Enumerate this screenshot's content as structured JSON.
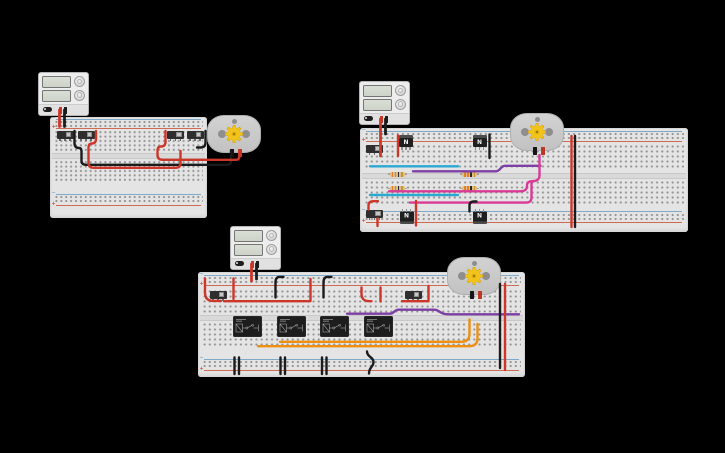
{
  "app": {
    "name": "circuit-canvas",
    "background": "#000000"
  },
  "labels": {
    "mosfet": "N",
    "rail_plus": "+",
    "rail_minus": "−"
  },
  "colors": {
    "board": "#e4e4e4",
    "wire_red": "#cc372a",
    "wire_black": "#1b1b1b",
    "wire_cyan": "#2aa9d2",
    "wire_purple": "#7d3fa5",
    "wire_pink": "#d93a96",
    "wire_orange": "#ed8f13",
    "gear": "#f2c318"
  },
  "board_layouts": {
    "b1": [
      {
        "t": "line",
        "y": 1.5,
        "color": "blue"
      },
      {
        "t": "holes",
        "y": 2.5,
        "h": 8,
        "rows": 2
      },
      {
        "t": "line",
        "y": 11,
        "color": "red"
      },
      {
        "t": "holes",
        "y": 13,
        "h": 22,
        "rows": 5
      },
      {
        "t": "channel",
        "y": 35.5,
        "h": 6.5
      },
      {
        "t": "holes",
        "y": 42.5,
        "h": 22,
        "rows": 5
      },
      {
        "t": "line",
        "y": 76.5,
        "color": "blue"
      },
      {
        "t": "holes",
        "y": 78,
        "h": 8,
        "rows": 2
      },
      {
        "t": "line",
        "y": 87.5,
        "color": "red"
      }
    ],
    "b2": [
      {
        "t": "line",
        "y": 2.5,
        "color": "blue"
      },
      {
        "t": "holes",
        "y": 3.5,
        "h": 8,
        "rows": 2
      },
      {
        "t": "line",
        "y": 12.5,
        "color": "red"
      },
      {
        "t": "holes",
        "y": 16,
        "h": 25,
        "rows": 5
      },
      {
        "t": "channel",
        "y": 44.5,
        "h": 6
      },
      {
        "t": "holes",
        "y": 51.5,
        "h": 25,
        "rows": 5
      },
      {
        "t": "line",
        "y": 83,
        "color": "blue"
      },
      {
        "t": "holes",
        "y": 84.5,
        "h": 8,
        "rows": 2
      },
      {
        "t": "line",
        "y": 94,
        "color": "red"
      }
    ],
    "b3": [
      {
        "t": "line",
        "y": 2.5,
        "color": "blue"
      },
      {
        "t": "holes",
        "y": 3.5,
        "h": 8,
        "rows": 2
      },
      {
        "t": "line",
        "y": 12.5,
        "color": "red"
      },
      {
        "t": "holes",
        "y": 16.5,
        "h": 25,
        "rows": 5
      },
      {
        "t": "channel",
        "y": 42.5,
        "h": 6
      },
      {
        "t": "holes",
        "y": 49.5,
        "h": 25,
        "rows": 5
      },
      {
        "t": "line",
        "y": 86.5,
        "color": "blue"
      },
      {
        "t": "holes",
        "y": 88,
        "h": 8,
        "rows": 2
      },
      {
        "t": "line",
        "y": 97.5,
        "color": "red"
      }
    ]
  },
  "circuits": [
    {
      "id": "switch-motor-circuit",
      "power_supply": {
        "x": 38,
        "y": 72
      },
      "boards": [
        {
          "x": 50,
          "y": 117,
          "w": 157,
          "h": 101,
          "hx": 4.9,
          "layout": "b1"
        }
      ],
      "motors": [
        {
          "x": 207,
          "y": 115
        }
      ],
      "switches": [
        {
          "x": 56.5,
          "y": 131
        },
        {
          "x": 77.5,
          "y": 131
        },
        {
          "x": 167,
          "y": 131
        },
        {
          "x": 186.5,
          "y": 131
        }
      ],
      "mosfets": [],
      "resistors": [],
      "relays": [],
      "wires": [
        {
          "c": "red",
          "w": 2.8,
          "d": "M59.5,110 V126.5"
        },
        {
          "c": "black",
          "w": 2.8,
          "d": "M64.5,110 V126.5"
        },
        {
          "c": "black",
          "d": "M74.5,131 V143 Q74.5,148 79,148 Q81.5,148 81.5,151.5 V160.5 Q81.5,164.8 86,164.8 H227 Q231,164.8 231,160.5 V150.5"
        },
        {
          "c": "red",
          "d": "M96,131 V138.5 Q96,143.5 92,143.5 Q88.5,143.5 88.5,147.5 V163 Q88.5,167.8 93.5,167.8 H175.5 Q180.5,167.8 180.5,163.5 V151"
        },
        {
          "c": "red",
          "d": "M165.5,131 V141.5 Q165.5,146.5 161,146.5 Q157.5,146.5 157.5,150.5 V155 Q157.5,159.8 162.5,159.8 H235.5 Q239.5,159.8 239.5,156 V150.5"
        },
        {
          "c": "black",
          "d": "M205.5,131 V142.5 Q205.5,147.5 200.5,147.5 H197"
        }
      ]
    },
    {
      "id": "mosfet-hbridge-circuit",
      "power_supply": {
        "x": 359,
        "y": 81
      },
      "boards": [
        {
          "x": 360,
          "y": 128,
          "w": 328,
          "h": 104,
          "hx": 5.2,
          "layout": "b2"
        }
      ],
      "motors": [
        {
          "x": 510,
          "y": 113
        }
      ],
      "switches": [
        {
          "x": 366,
          "y": 145
        },
        {
          "x": 366,
          "y": 210
        }
      ],
      "mosfets": [
        {
          "x": 399,
          "y": 135
        },
        {
          "x": 472.5,
          "y": 135
        },
        {
          "x": 399.5,
          "y": 209,
          "flip": 1
        },
        {
          "x": 472.5,
          "y": 209,
          "flip": 1
        }
      ],
      "resistors": [
        {
          "x": 387.5,
          "y": 171.5
        },
        {
          "x": 460,
          "y": 171.5
        },
        {
          "x": 387.5,
          "y": 185.8
        },
        {
          "x": 460,
          "y": 185.8
        }
      ],
      "relays": [],
      "wires": [
        {
          "c": "red",
          "w": 2.8,
          "d": "M380.5,119 V156"
        },
        {
          "c": "black",
          "w": 2.8,
          "d": "M385.5,119 V134"
        },
        {
          "c": "red",
          "d": "M398,135.5 V156"
        },
        {
          "c": "black",
          "d": "M489.5,134.5 V158"
        },
        {
          "c": "cyan",
          "d": "M370,166.3 H458"
        },
        {
          "c": "purple",
          "d": "M413,171.3 H496 C500.5,171.3 500.5,165.8 505,165.8 H540.5"
        },
        {
          "c": "pink",
          "d": "M389,191.3 H520 C525,191.3 527,189.5 527,185.8 C527,182.3 529,181.2 532,181.2 C536,181.2 539.5,179.8 539.5,175.5 V155"
        },
        {
          "c": "cyan",
          "d": "M370,195 H458"
        },
        {
          "c": "pink",
          "d": "M410,202.6 H526 C530.5,202.6 531.5,200.5 531.5,196.5 V183"
        },
        {
          "c": "red",
          "d": "M368.5,209.5 V205.5 Q368.5,201.2 373.5,201.2 H378"
        },
        {
          "c": "red",
          "d": "M416,201 V225.5"
        },
        {
          "c": "black",
          "d": "M469.5,211.5 V205.5 Q469.5,201.5 474,201.5 H476.5"
        },
        {
          "c": "red",
          "d": "M377.5,218.5 V226"
        },
        {
          "c": "red",
          "d": "M571.5,136 V227"
        },
        {
          "c": "black",
          "d": "M575,136 V227"
        }
      ]
    },
    {
      "id": "relay-motor-circuit",
      "power_supply": {
        "x": 230,
        "y": 226
      },
      "boards": [
        {
          "x": 198,
          "y": 272,
          "w": 327,
          "h": 105,
          "hx": 5.2,
          "layout": "b3"
        }
      ],
      "motors": [
        {
          "x": 447,
          "y": 257
        }
      ],
      "switches": [
        {
          "x": 209.5,
          "y": 291
        },
        {
          "x": 404.5,
          "y": 291
        }
      ],
      "mosfets": [],
      "resistors": [],
      "relays": [
        {
          "x": 233,
          "y": 316
        },
        {
          "x": 276.5,
          "y": 316
        },
        {
          "x": 320,
          "y": 316
        },
        {
          "x": 363.5,
          "y": 316
        }
      ],
      "wires": [
        {
          "c": "red",
          "w": 2.8,
          "d": "M251.5,264 V281"
        },
        {
          "c": "black",
          "w": 2.8,
          "d": "M256.5,264 V279"
        },
        {
          "c": "red",
          "d": "M205,278.5 V292.5 C205,298.5 208,300.9 213,300.9 H221"
        },
        {
          "c": "red",
          "d": "M233.5,278.5 V299"
        },
        {
          "c": "red",
          "d": "M224,301.2 H310"
        },
        {
          "c": "red",
          "d": "M310.5,279 V301"
        },
        {
          "c": "black",
          "d": "M283.5,276.9 H279.5 C276.5,276.9 275.5,279 275.5,282.5 V297.5"
        },
        {
          "c": "black",
          "d": "M331.5,276.9 H327.5 C324.5,276.9 323.5,279 323.5,282.5 V297.5"
        },
        {
          "c": "red",
          "d": "M361.5,287.5 V293.5 C361.5,299.3 364.5,301.2 369.5,301.2 H371.5"
        },
        {
          "c": "red",
          "d": "M380.5,287.5 V301.5"
        },
        {
          "c": "red",
          "d": "M402,301.2 H428.5"
        },
        {
          "c": "red",
          "d": "M428.5,300 V286"
        },
        {
          "c": "purple",
          "d": "M347,313.7 H390 C394,313.7 394.5,309.7 398.5,309.7 H434 C437.5,309.7 437.5,310.6 440,312 C442.3,313.3 444,314.3 448,314.3 H519"
        },
        {
          "c": "orange",
          "d": "M280,341.8 H461 C466.5,341.8 469.5,339.2 469.5,334 V319.5"
        },
        {
          "c": "orange",
          "d": "M258,346.2 H469 C474.5,346.2 477.5,343.6 477.5,338.5 V324"
        },
        {
          "c": "black",
          "d": "M234.5,357.5 V374"
        },
        {
          "c": "black",
          "d": "M239,357.5 V374"
        },
        {
          "c": "black",
          "d": "M280.5,357.5 V374"
        },
        {
          "c": "black",
          "d": "M285,357.5 V374"
        },
        {
          "c": "black",
          "d": "M322,357.5 V374"
        },
        {
          "c": "black",
          "d": "M326.5,357.5 V374"
        },
        {
          "c": "black",
          "d": "M367,351.5 C367,357 373.5,357 373.5,362 C373.5,367 369,367 369,373.5"
        },
        {
          "c": "black",
          "d": "M500,284 V368"
        },
        {
          "c": "red",
          "d": "M505,284 V370"
        }
      ]
    }
  ]
}
